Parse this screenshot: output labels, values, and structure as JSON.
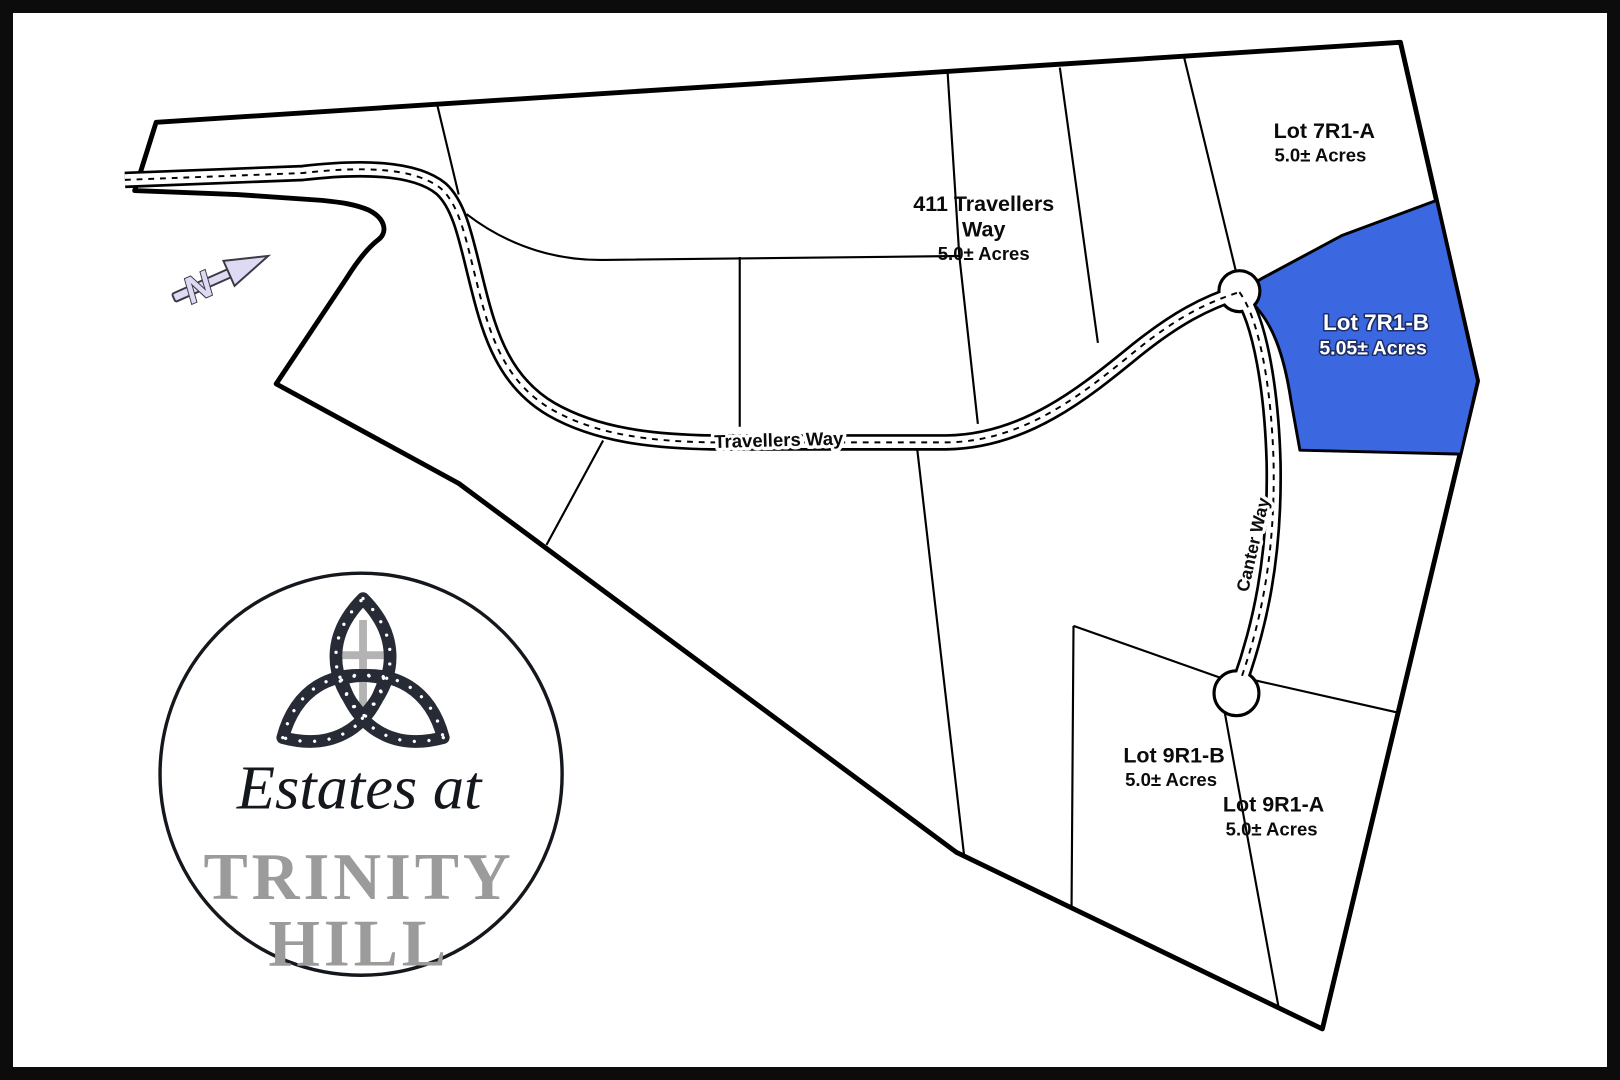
{
  "logo": {
    "script_line": "Estates at",
    "big_line1": "TRINITY",
    "big_line2": "HILL"
  },
  "north_arrow": {
    "label": "N"
  },
  "roads": {
    "travellers_way": "Travellers Way",
    "canter_way": "Canter Way"
  },
  "lots": {
    "lot411": {
      "name_line1": "411 Travellers",
      "name_line2": "Way",
      "acres": "5.0± Acres"
    },
    "lot7r1a": {
      "name": "Lot 7R1-A",
      "acres": "5.0± Acres"
    },
    "lot7r1b": {
      "name": "Lot 7R1-B",
      "acres": "5.05± Acres",
      "highlight_color": "#3B67E0"
    },
    "lot9r1b": {
      "name": "Lot 9R1-B",
      "acres": "5.0± Acres"
    },
    "lot9r1a": {
      "name": "Lot 9R1-A",
      "acres": "5.0± Acres"
    }
  },
  "colors": {
    "line": "#000000",
    "highlight_blue": "#3B67E0",
    "logo_gray": "#9b9b9b",
    "knot_dark": "#262b36",
    "cross_gray": "#b3b3b3",
    "arrow_lavender": "#dfdaf3",
    "arrow_outline": "#3a3a45"
  }
}
